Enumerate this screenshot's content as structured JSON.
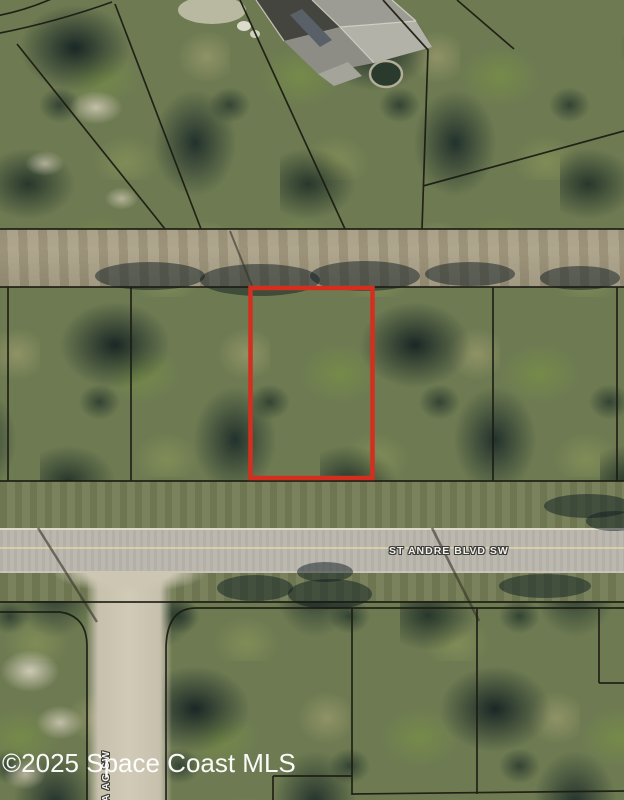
{
  "map": {
    "watermark": "©2025 Space Coast MLS",
    "streets": {
      "main": "ST ANDRE BLVD SW",
      "side": "YA AC SW"
    },
    "highlight_color": "#d42f1e",
    "boundary_color": "#1b1b12"
  }
}
